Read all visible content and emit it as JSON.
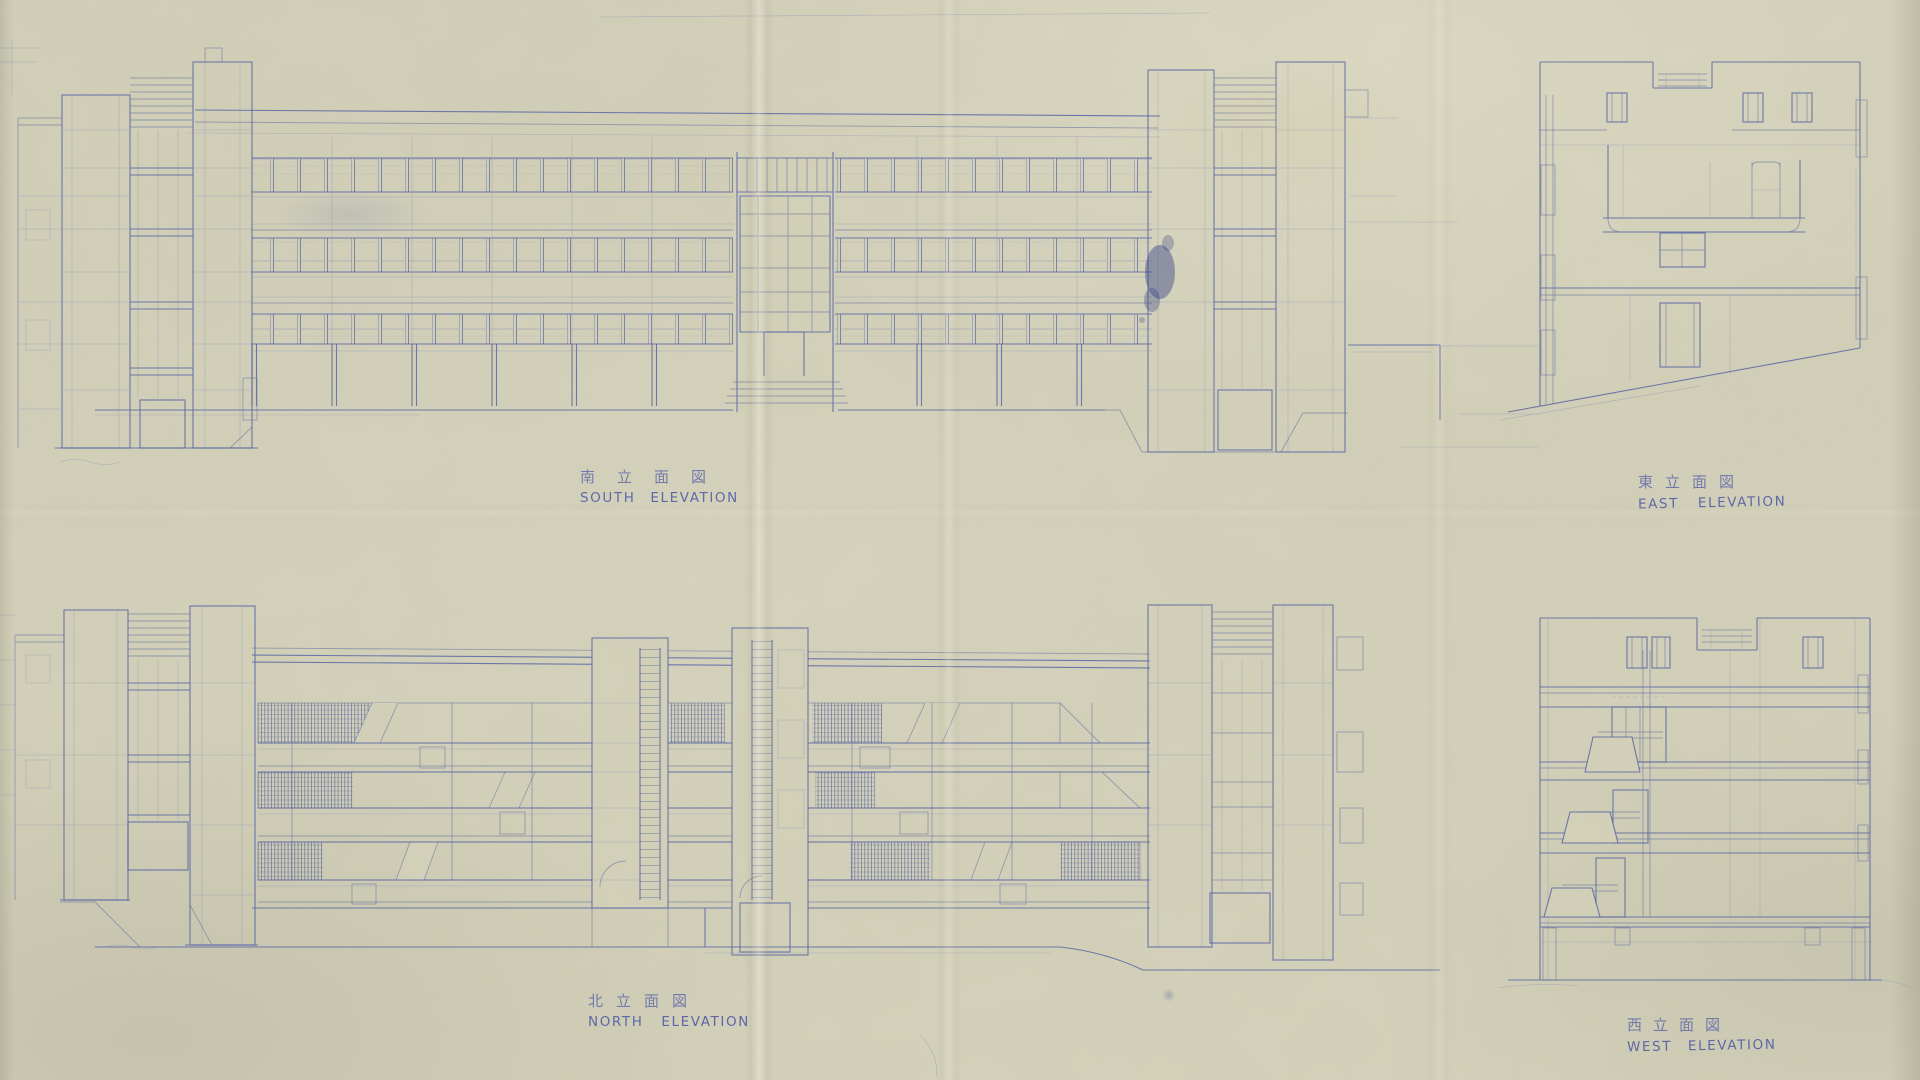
{
  "sheet": {
    "kind": "hand-drawn architectural elevation blueprint, blue ink on aged paper",
    "colors": {
      "paper": "#d6d3ba",
      "ink": "#4e5ea2",
      "ink_light": "#8a93b8",
      "ink_heavy": "#3a4a95",
      "caption_ink": "#4754a6"
    }
  },
  "captions": {
    "south": {
      "kanji": "南立面図",
      "english": "SOUTH ELEVATION"
    },
    "east": {
      "kanji": "東立面図",
      "english": "EAST ELEVATION"
    },
    "north": {
      "kanji": "北立面図",
      "english": "NORTH ELEVATION"
    },
    "west": {
      "kanji": "西立面図",
      "english": "WEST ELEVATION"
    }
  },
  "drawings": [
    {
      "id": "south-elevation",
      "label": "SOUTH ELEVATION",
      "position": "top-left",
      "description": "long 3-storey slab on pilotis between two stair towers"
    },
    {
      "id": "east-elevation",
      "label": "EAST ELEVATION",
      "position": "top-right",
      "description": "end elevation with roof notch, balcony and sloping ground"
    },
    {
      "id": "north-elevation",
      "label": "NORTH ELEVATION",
      "position": "bottom-left",
      "description": "long slab with hatched glazing bands and two stair towers"
    },
    {
      "id": "west-elevation",
      "label": "WEST ELEVATION",
      "position": "bottom-right",
      "description": "end elevation with stacked stair balconies"
    }
  ]
}
